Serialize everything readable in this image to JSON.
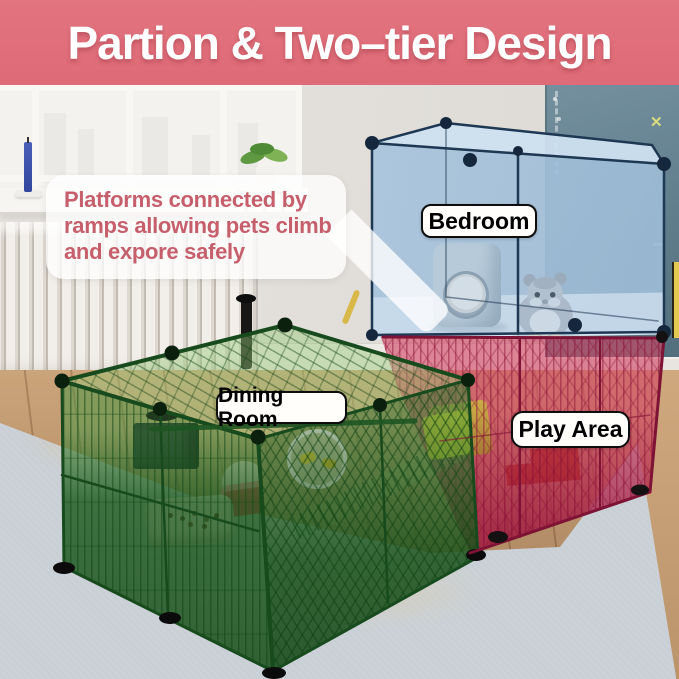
{
  "header": {
    "title": "Partion & Two–tier Design"
  },
  "callout": {
    "line1": "Platforms connected by",
    "line2": "ramps allowing pets climb",
    "line3": "and expore safely"
  },
  "labels": {
    "bedroom": "Bedroom",
    "dining_room": "Dining Room",
    "play_area": "Play Area"
  },
  "colors": {
    "header_bg": "#E0707B",
    "header_text": "#FFFFFF",
    "callout_text": "#C65F6B",
    "label_bg": "#FFFEFB",
    "label_border": "#111111",
    "cage_green": "#3E8A42",
    "cage_pink": "#CE4768",
    "bedroom_blue": "#AEC9E0",
    "wall_right_blue": "#63808F",
    "wall_left_grey": "#E4E1DD",
    "rug": "#C8CFD5",
    "wood_floor": "#C09A72"
  }
}
